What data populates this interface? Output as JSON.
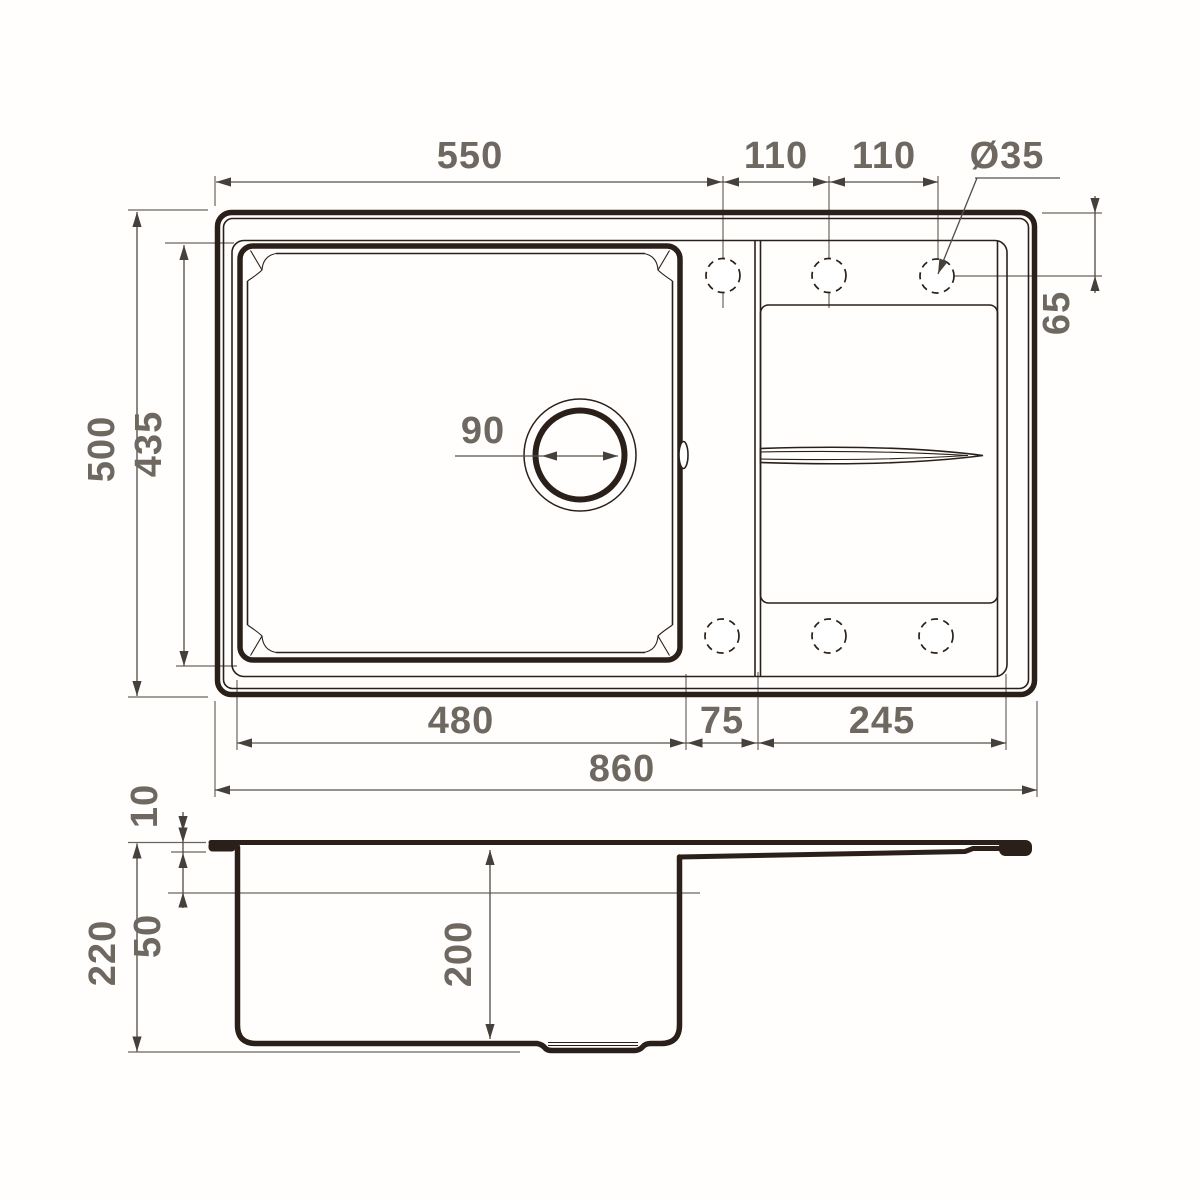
{
  "drawing": {
    "type": "sink-technical-drawing",
    "ink_color": "#2a2019",
    "dimension_line_color": "#56504a",
    "dimension_text_color": "#6e6861",
    "background_color": "#ffffff"
  },
  "dimensions": {
    "top": {
      "overall_cutout_width": "550",
      "hole_pitch_left": "110",
      "hole_pitch_right": "110",
      "hole_diameter": "Ø35"
    },
    "right": {
      "hole_center_offset": "65"
    },
    "left": {
      "overall_depth": "500",
      "bowl_outer_depth": "435"
    },
    "drain": {
      "diameter": "90"
    },
    "bottom": {
      "bowl_outer_width": "480",
      "bowl_to_board_gap": "75",
      "drainboard_width": "245",
      "overall_width": "860"
    },
    "side": {
      "rim_lip_height": "10",
      "ledge_depth": "50",
      "overall_height": "220",
      "bowl_inner_depth": "200"
    }
  }
}
